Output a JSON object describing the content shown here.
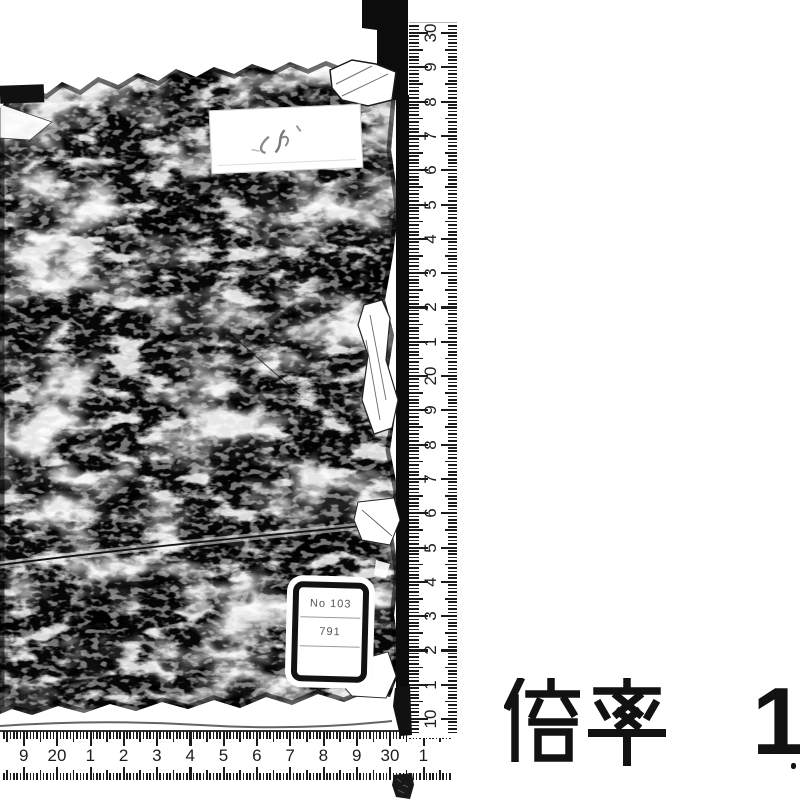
{
  "labels": {
    "title_slip": {
      "handwriting_marks": "faint illegible strokes"
    },
    "catalog_sticker": {
      "line1": "No 103",
      "line2": "791",
      "line3": ""
    }
  },
  "rulers": {
    "vertical": {
      "numbers": [
        "30",
        "9",
        "8",
        "7",
        "6",
        "5",
        "4",
        "3",
        "2",
        "1",
        "20",
        "9",
        "8",
        "7",
        "6",
        "5",
        "4",
        "3",
        "2",
        "1",
        "10"
      ]
    },
    "horizontal": {
      "numbers": [
        "9",
        "20",
        "1",
        "2",
        "3",
        "4",
        "5",
        "6",
        "7",
        "8",
        "9",
        "30",
        "1"
      ]
    }
  },
  "caption": {
    "magnification_label": "倍率",
    "magnification_value": "1"
  },
  "colors": {
    "ink": "#111111",
    "paper": "#ffffff"
  }
}
